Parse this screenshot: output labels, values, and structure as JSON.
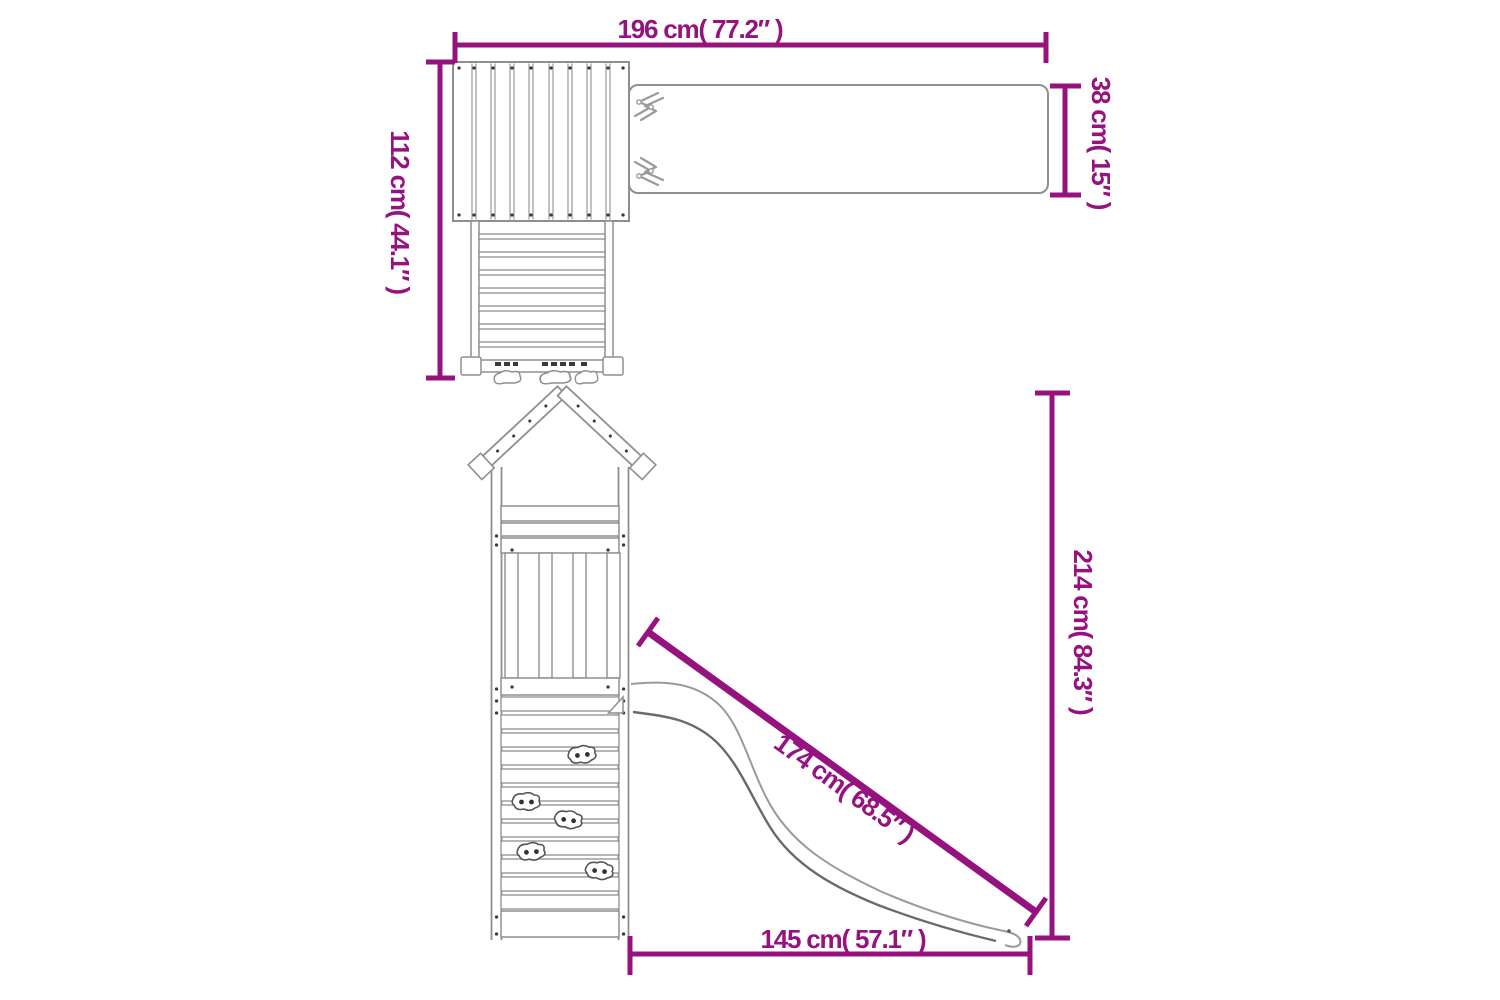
{
  "page": {
    "background": "#ffffff"
  },
  "palette": {
    "dimension_color": "#96127E",
    "outline_gray": "#8f8f8f",
    "outline_dark": "#6a6a6a",
    "screw_dot_color": "#3a3a3a"
  },
  "diagram": {
    "subject": "wooden play tower with swing beam, climbing wall and slide — dimension drawing",
    "top_view": {
      "dim_total_width": "196 cm( 77.2″ )",
      "dim_total_depth": "112 cm( 44.1″ )",
      "dim_beam_width": "38 cm( 15″ )"
    },
    "side_view": {
      "dim_total_height": "214 cm( 84.3″ )",
      "dim_slide_length": "174 cm( 68.5″ )",
      "dim_base_width": "145 cm( 57.1″ )"
    }
  }
}
